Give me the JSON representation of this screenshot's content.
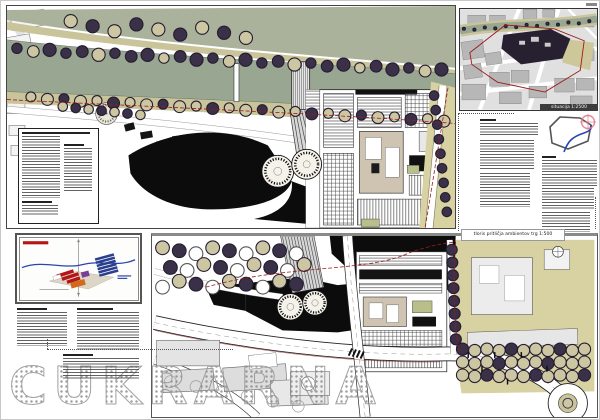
{
  "watermark": {
    "text": "CUKRARNA"
  },
  "inset_map": {
    "caption": "situacija 1:2500"
  },
  "bottom_map": {
    "caption": "tloris pritličja ambientov trg 1:500"
  },
  "palette": {
    "river": "#98a692",
    "lawn": "#aab29c",
    "bank_khaki": "#c9c49a",
    "park_khaki": "#d8d2a2",
    "tree_dark": "#3a3048",
    "tree_beige": "#cdc6a2",
    "plaza_black": "#0c0c0c",
    "boundary_red": "#9b1a1a",
    "river_line_blue": "#2a44b0",
    "crosshair_pink": "#e87888",
    "program_red": "#b51515",
    "program_orange": "#d2691e",
    "program_purple": "#7a3f9a",
    "program_blue": "#2a3f8f"
  }
}
